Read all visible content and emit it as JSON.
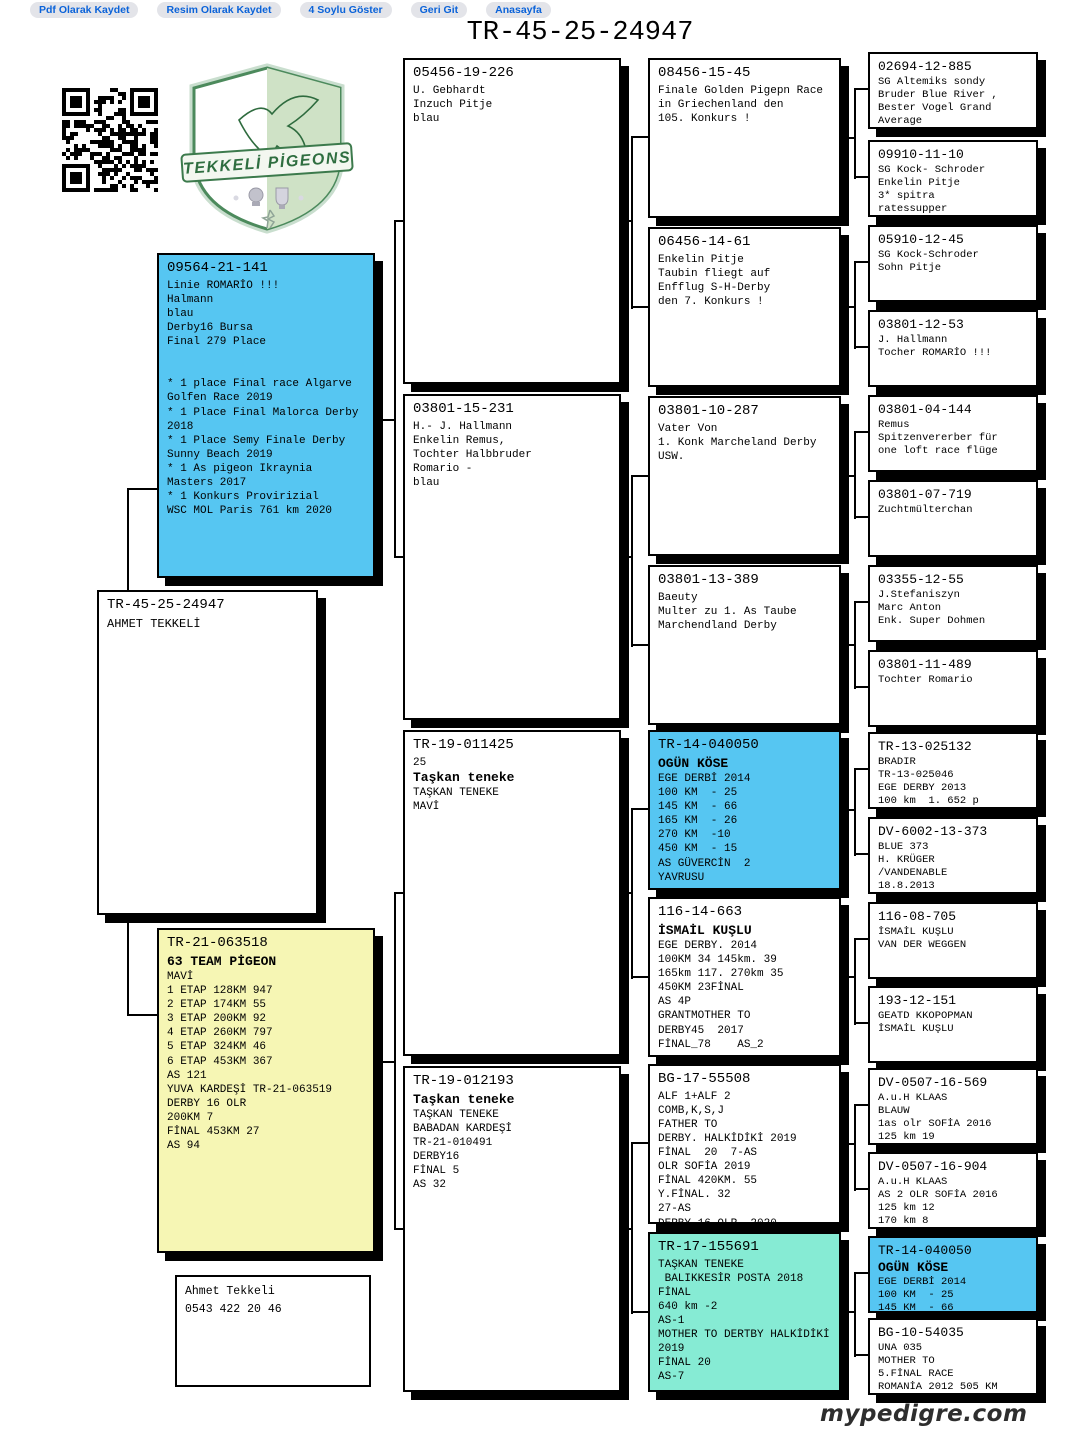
{
  "nav": {
    "buttons": [
      "Pdf Olarak Kaydet",
      "Resim Olarak Kaydet",
      "4 Soylu Göster",
      "Geri Git",
      "Anasayfa"
    ]
  },
  "title": "TR-45-25-24947",
  "watermark": "mypedigre.com",
  "logo": {
    "banner": "TEKKELİ PİGEONS"
  },
  "contact": {
    "name": "Ahmet Tekkeli",
    "phone": "0543 422 20 46"
  },
  "colors": {
    "box_blue": "#56c6f2",
    "box_yellow": "#f6f6b4",
    "box_teal": "#86ebd4",
    "nav_text": "#0b63d9",
    "shadow": "#000000",
    "logo_green": "#3c7a4c"
  },
  "gen1": {
    "subject": {
      "ring": "TR-45-25-24947",
      "body": "AHMET TEKKELİ"
    }
  },
  "gen2": [
    {
      "ring": "09564-21-141",
      "body": "Linie ROMARİO !!!\nHalmann\nblau\nDerby16 Bursa\nFinal 279 Place\n\n\n* 1 place Final race Algarve\nGolfen Race 2019\n* 1 Place Final Malorca Derby\n2018\n* 1 Place Semy Finale Derby\nSunny Beach 2019\n* 1 As pigeon Ikraynia\nMasters 2017\n* 1 Konkurs Provirizial\nWSC MOL Paris 761 km 2020"
    },
    {
      "ring": "TR-21-063518",
      "name": "63 TEAM PİGEON",
      "body": "MAVİ\n1 ETAP 128KM 947\n2 ETAP 174KM 55\n3 ETAP 200KM 92\n4 ETAP 260KM 797\n5 ETAP 324KM 46\n6 ETAP 453KM 367\nAS 121\nYUVA KARDEŞİ TR-21-063519\nDERBY 16 OLR\n200KM 7\nFİNAL 453KM 27\nAS 94"
    }
  ],
  "gen3": [
    {
      "ring": "05456-19-226",
      "body": "U. Gebhardt\nInzuch Pitje\nblau"
    },
    {
      "ring": "03801-15-231",
      "body": "H.- J. Hallmann\nEnkelin Remus,\nTochter Halbbruder\nRomario -\nblau"
    },
    {
      "ring": "TR-19-011425",
      "pre": "25",
      "name": "Taşkan teneke",
      "body": "TAŞKAN TENEKE\nMAVİ"
    },
    {
      "ring": "TR-19-012193",
      "name": "Taşkan teneke",
      "body": "TAŞKAN TENEKE\nBABADAN KARDEŞİ\nTR-21-010491\nDERBY16\nFİNAL 5\nAS 32"
    }
  ],
  "gen4": [
    {
      "ring": "08456-15-45",
      "body": "Finale Golden Pigepn Race\nin Griechenland den\n105. Konkurs !"
    },
    {
      "ring": "06456-14-61",
      "body": "Enkelin Pitje\nTaubin fliegt auf\nEnfflug S-H-Derby\nden 7. Konkurs !"
    },
    {
      "ring": "03801-10-287",
      "body": "Vater Von\n1. Konk Marcheland Derby\nUSW."
    },
    {
      "ring": "03801-13-389",
      "body": "Baeuty\nMulter zu 1. As Taube\nMarchendland Derby"
    },
    {
      "ring": "TR-14-040050",
      "name": "OGÜN KÖSE",
      "body": "EGE DERBİ 2014\n100 KM  - 25\n145 KM  - 66\n165 KM  - 26\n270 KM  -10\n450 KM  - 15\nAS GÜVERCİN  2\nYAVRUSU"
    },
    {
      "ring": "116-14-663",
      "name": "İSMAİL KUŞLU",
      "body": "EGE DERBY. 2014\n100KM 34 145km. 39\n165km 117. 270km 35\n450KM 23FİNAL\nAS 4P\nGRANTMOTHER TO\nDERBY45  2017\nFİNAL_78    AS_2"
    },
    {
      "ring": "BG-17-55508",
      "body": "ALF 1+ALF 2\nCOMB,K,S,J\nFATHER TO\nDERBY. HALKİDİKİ 2019\nFİNAL  20  7-AS\nOLR SOFİA 2019\nFİNAL 420KM. 55\nY.FİNAL. 32\n27-AS\nDERBY 16 OLR  2020"
    },
    {
      "ring": "TR-17-155691",
      "body": "TAŞKAN TENEKE\n BALIKKESİR POSTA 2018\nFİNAL\n640 km -2\nAS-1\nMOTHER TO DERTBY HALKİDİKİ\n2019\nFİNAL 20\nAS-7"
    }
  ],
  "gen5": [
    {
      "ring": "02694-12-885",
      "body": "SG Altemiks sondy\nBruder Blue River ,\nBester Vogel Grand\nAverage"
    },
    {
      "ring": "09910-11-10",
      "body": "SG Kock- Schroder\nEnkelin Pitje\n3* spitra\nratessupper"
    },
    {
      "ring": "05910-12-45",
      "body": "SG Kock-Schroder\nSohn Pitje"
    },
    {
      "ring": "03801-12-53",
      "body": "J. Hallmann\nTocher ROMARİO !!!"
    },
    {
      "ring": "03801-04-144",
      "body": "Remus\nSpitzenvererber für\none loft race flüge"
    },
    {
      "ring": "03801-07-719",
      "body": "Zuchtmülterchan"
    },
    {
      "ring": "03355-12-55",
      "body": "J.Stefaniszyn\nMarc Anton\nEnk. Super Dohmen"
    },
    {
      "ring": "03801-11-489",
      "body": "Tochter Romario"
    },
    {
      "ring": "TR-13-025132",
      "body": "BRADIR\nTR-13-025046\nEGE DERBY 2013\n100 km  1. 652 p"
    },
    {
      "ring": "DV-6002-13-373",
      "body": "BLUE 373\nH. KRÜGER\n/VANDENABLE\n18.8.2013"
    },
    {
      "ring": "116-08-705",
      "body": "İSMAİL KUŞLU\nVAN DER WEGGEN"
    },
    {
      "ring": "193-12-151",
      "body": "GEATD KKOPOPMAN\nİSMAİL KUŞLU"
    },
    {
      "ring": "DV-0507-16-569",
      "body": "A.u.H KLAAS\nBLAUW\n1as olr SOFİA 2016\n125 km 19"
    },
    {
      "ring": "DV-0507-16-904",
      "body": "A.u.H KLAAS\nAS 2 OLR SOFİA 2016\n125 km 12\n170 km 8"
    },
    {
      "ring": "TR-14-040050",
      "name": "OGÜN KÖSE",
      "body": "EGE DERBİ 2014\n100 KM  - 25\n145 KM  - 66"
    },
    {
      "ring": "BG-10-54035",
      "body": "UNA 035\nMOTHER TO\n5.FİNAL RACE\nROMANİA 2012 505 KM"
    }
  ]
}
